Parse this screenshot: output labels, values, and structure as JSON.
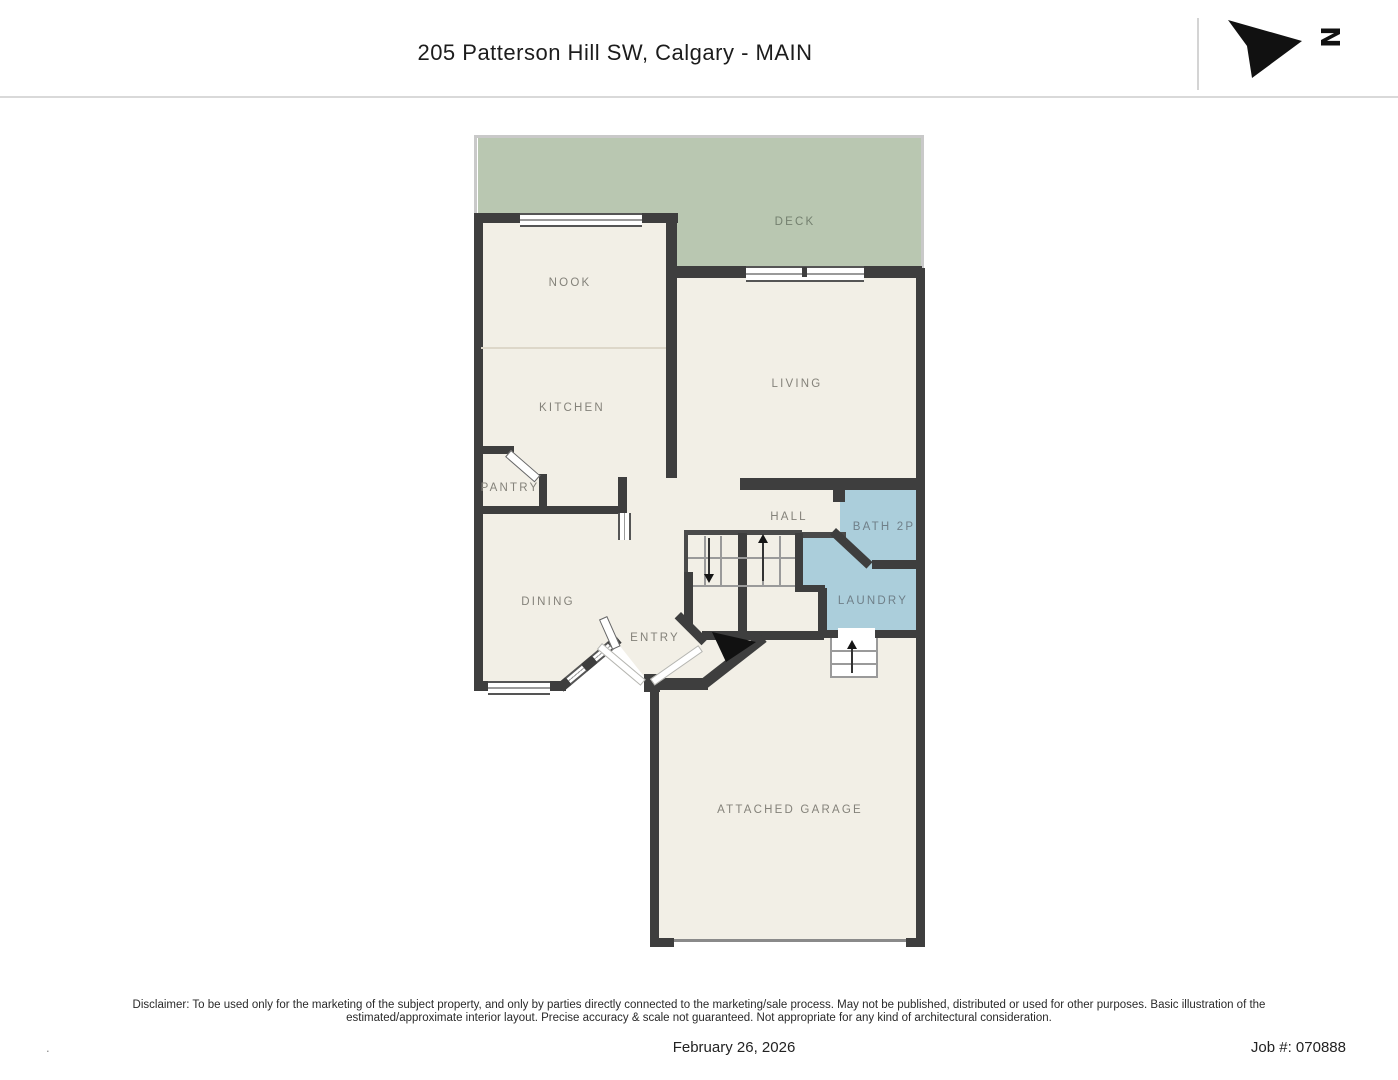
{
  "header": {
    "title": "205 Patterson Hill SW, Calgary - MAIN",
    "compass_letter": "N"
  },
  "plan": {
    "rooms": [
      {
        "id": "deck",
        "label": "DECK"
      },
      {
        "id": "nook",
        "label": "NOOK"
      },
      {
        "id": "kitchen",
        "label": "KITCHEN"
      },
      {
        "id": "living",
        "label": "LIVING"
      },
      {
        "id": "pantry",
        "label": "PANTRY"
      },
      {
        "id": "dining",
        "label": "DINING"
      },
      {
        "id": "entry",
        "label": "ENTRY"
      },
      {
        "id": "hall",
        "label": "HALL"
      },
      {
        "id": "bath",
        "label": "BATH 2P"
      },
      {
        "id": "laundry",
        "label": "LAUNDRY"
      },
      {
        "id": "garage",
        "label": "ATTACHED GARAGE"
      }
    ],
    "colors": {
      "wall": "#3e3e3e",
      "floor": "#f2efe6",
      "deck": "#b9c7b1",
      "wet_rooms": "#abcedb",
      "label_text": "#84827a"
    }
  },
  "footer": {
    "disclaimer_line1": "Disclaimer: To be used only for the marketing of the subject property, and only by parties directly connected to the marketing/sale process. May not be published, distributed or used for other purposes. Basic illustration of the",
    "disclaimer_line2": "estimated/approximate interior layout. Precise accuracy & scale not guaranteed. Not appropriate for any kind of architectural consideration.",
    "date": "February 26, 2026",
    "job_number": "Job #: 070888",
    "corner_mark": "."
  }
}
